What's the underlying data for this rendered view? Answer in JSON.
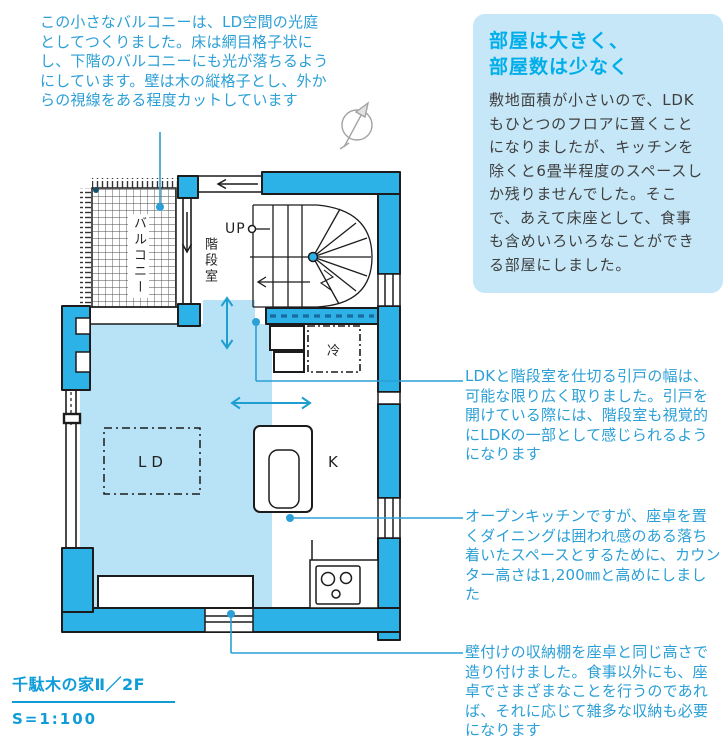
{
  "callout_balcony": {
    "text": "この小さなバルコニーは、LD空間の光庭としてつくりました。床は網目格子状にし、下階のバルコニーにも光が落ちるようにしています。壁は木の縦格子とし、外からの視線をある程度カットしています"
  },
  "info_box": {
    "heading_line1": "部屋は大きく、",
    "heading_line2": "部屋数は少なく",
    "body": "敷地面積が小さいので、LDKもひとつのフロアに置くことになりましたが、キッチンを除くと6畳半程度のスペースしか残りませんでした。そこで、あえて床座として、食事も含めいろいろなことができる部屋にしました。"
  },
  "plan": {
    "labels": {
      "balcony": "バルコニー",
      "stair_room": "階段室",
      "up": "UP",
      "fridge": "冷",
      "living_dining": "LD",
      "kitchen": "K"
    }
  },
  "annotations": [
    {
      "text": "LDKと階段室を仕切る引戸の幅は、可能な限り広く取りました。引戸を開けている際には、階段室も視覚的にLDKの一部として感じられるようになります"
    },
    {
      "text": "オープンキッチンですが、座卓を置くダイニングは囲われ感のある落ち着いたスペースとするために、カウンター高さは1,200㎜と高めにしました"
    },
    {
      "text": "壁付けの収納棚を座卓と同じ高さで造り付けました。食事以外にも、座卓でさまざまなことを行うのであれば、それに応じて雑多な収納も必要になります"
    }
  ],
  "caption": {
    "title": "千駄木の家Ⅱ／2F",
    "scale": "S=1:100"
  },
  "colors": {
    "wall_cyan": "#2cb2e6",
    "floor_light_blue": "#b8e3f7",
    "info_box_bg": "#c6e7f7",
    "heading_cyan": "#00aeea",
    "annotation_blue": "#2b9fd6",
    "line_black": "#1c1c1c"
  }
}
